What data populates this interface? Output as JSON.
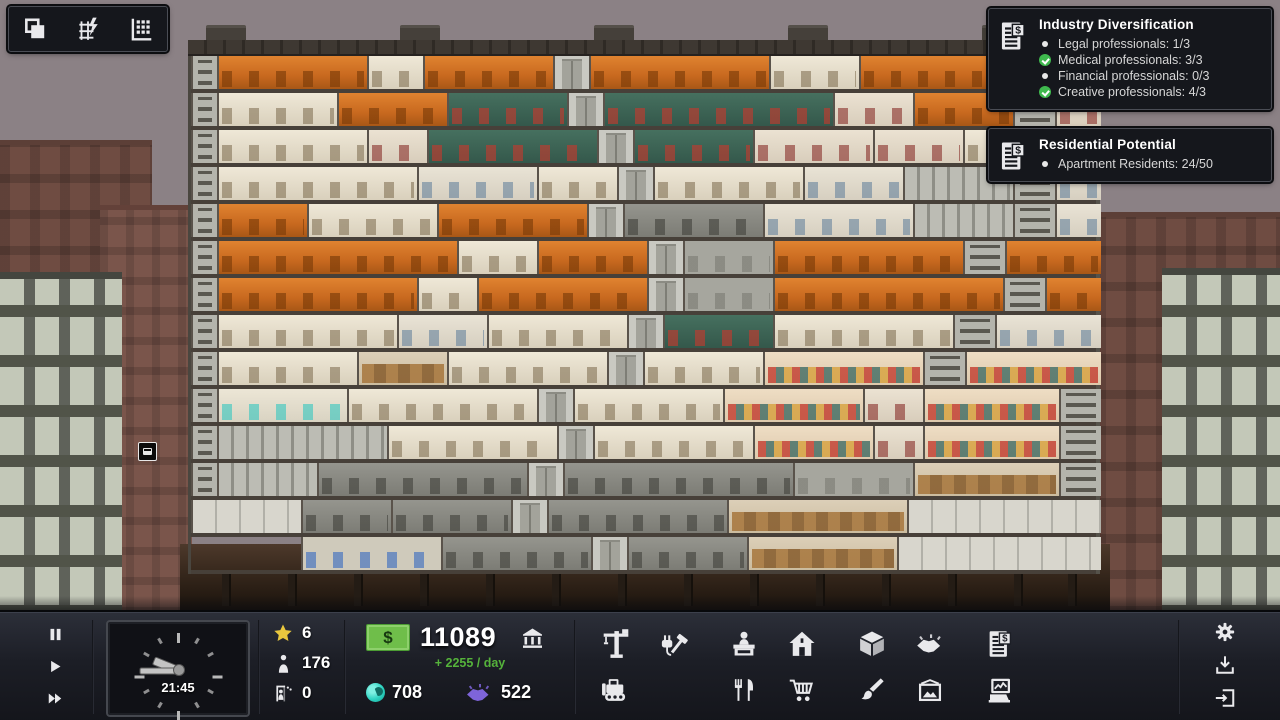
{
  "palette": {
    "sky": "#8b8185",
    "toolbar_bg": "#1c1e26",
    "panel_bg": "#15171c",
    "money_green": "#6fbe4a",
    "income_green": "#55b33b",
    "star_yellow": "#e9c73e",
    "influence_cyan": "#2fd3c2",
    "favors_purple": "#7e64da",
    "check_green": "#3fb94e",
    "office_orange": "#c8691f",
    "diner_teal": "#3f685e"
  },
  "top_left_toolbar": {
    "buttons": [
      {
        "icon": "layers-icon"
      },
      {
        "icon": "power-grid-icon"
      },
      {
        "icon": "building-stats-icon"
      }
    ]
  },
  "notifications": [
    {
      "icon": "financial-report-icon",
      "title": "Industry Diversification",
      "items": [
        {
          "text": "Legal professionals: 1/3",
          "state": "open"
        },
        {
          "text": "Medical professionals: 3/3",
          "state": "done"
        },
        {
          "text": "Financial professionals: 0/3",
          "state": "open"
        },
        {
          "text": "Creative professionals: 4/3",
          "state": "done"
        }
      ]
    },
    {
      "icon": "financial-report-icon",
      "title": "Residential Potential",
      "items": [
        {
          "text": "Apartment Residents: 24/50",
          "state": "open"
        }
      ]
    }
  ],
  "toolbar": {
    "clock": {
      "time": "21:45"
    },
    "stats": {
      "prestige": "6",
      "population": "176",
      "vacancies": "0"
    },
    "finance": {
      "currency_symbol": "$",
      "balance": "11089",
      "income_per_day": "+ 2255 / day",
      "influence": "708",
      "favors": "522"
    },
    "tool_icons": [
      "crane",
      "utilities-repair",
      "bulldozer",
      "receptionist",
      "house",
      "food-service",
      "retail-cart",
      "services-box",
      "deals-handshake",
      "contracts-report",
      "decorate-brush",
      "artwork-picture",
      "reports-computer"
    ],
    "system_icons": [
      "settings-gear",
      "save-download",
      "exit-door"
    ]
  },
  "building": {
    "floors": [
      [
        [
          26,
          "shaft"
        ],
        [
          150,
          "office"
        ],
        [
          56,
          "studio"
        ],
        [
          130,
          "office"
        ],
        [
          36,
          "elevator"
        ],
        [
          180,
          "office"
        ],
        [
          90,
          "studio"
        ],
        [
          150,
          "office"
        ],
        [
          46,
          "shaft"
        ],
        [
          46,
          "office"
        ]
      ],
      [
        [
          26,
          "shaft"
        ],
        [
          120,
          "studio"
        ],
        [
          110,
          "office"
        ],
        [
          120,
          "diner"
        ],
        [
          36,
          "elevator"
        ],
        [
          230,
          "diner"
        ],
        [
          80,
          "medical"
        ],
        [
          100,
          "office"
        ],
        [
          42,
          "shaft"
        ],
        [
          46,
          "medical"
        ]
      ],
      [
        [
          26,
          "shaft"
        ],
        [
          150,
          "studio"
        ],
        [
          60,
          "medical"
        ],
        [
          170,
          "diner"
        ],
        [
          36,
          "elevator"
        ],
        [
          120,
          "diner"
        ],
        [
          120,
          "medical"
        ],
        [
          90,
          "medical"
        ],
        [
          96,
          "studio"
        ],
        [
          42,
          "shaft"
        ]
      ],
      [
        [
          26,
          "shaft"
        ],
        [
          200,
          "studio"
        ],
        [
          120,
          "apartment"
        ],
        [
          80,
          "studio"
        ],
        [
          36,
          "elevator"
        ],
        [
          150,
          "studio"
        ],
        [
          100,
          "apartment"
        ],
        [
          110,
          "lockers"
        ],
        [
          42,
          "shaft"
        ],
        [
          46,
          "apartment"
        ]
      ],
      [
        [
          26,
          "shaft"
        ],
        [
          90,
          "office"
        ],
        [
          130,
          "studio"
        ],
        [
          150,
          "office"
        ],
        [
          36,
          "elevator"
        ],
        [
          140,
          "utility"
        ],
        [
          150,
          "apartment"
        ],
        [
          100,
          "lockers"
        ],
        [
          42,
          "shaft"
        ],
        [
          46,
          "apartment"
        ]
      ],
      [
        [
          26,
          "shaft"
        ],
        [
          240,
          "office"
        ],
        [
          80,
          "studio"
        ],
        [
          110,
          "office"
        ],
        [
          36,
          "elevator"
        ],
        [
          90,
          "gray"
        ],
        [
          190,
          "office"
        ],
        [
          42,
          "shaft"
        ],
        [
          96,
          "office"
        ]
      ],
      [
        [
          26,
          "shaft"
        ],
        [
          200,
          "office"
        ],
        [
          60,
          "studio"
        ],
        [
          170,
          "office"
        ],
        [
          36,
          "elevator"
        ],
        [
          90,
          "gray"
        ],
        [
          230,
          "office"
        ],
        [
          42,
          "shaft"
        ],
        [
          56,
          "office"
        ]
      ],
      [
        [
          26,
          "shaft"
        ],
        [
          180,
          "studio"
        ],
        [
          90,
          "apartment"
        ],
        [
          140,
          "studio"
        ],
        [
          36,
          "elevator"
        ],
        [
          110,
          "diner"
        ],
        [
          180,
          "studio"
        ],
        [
          42,
          "shaft"
        ],
        [
          106,
          "apartment"
        ]
      ],
      [
        [
          26,
          "shaft"
        ],
        [
          140,
          "studio"
        ],
        [
          90,
          "storage"
        ],
        [
          160,
          "studio"
        ],
        [
          36,
          "elevator"
        ],
        [
          120,
          "studio"
        ],
        [
          160,
          "market"
        ],
        [
          42,
          "shaft"
        ],
        [
          136,
          "market"
        ]
      ],
      [
        [
          26,
          "shaft"
        ],
        [
          130,
          "laundry"
        ],
        [
          190,
          "studio"
        ],
        [
          36,
          "elevator"
        ],
        [
          150,
          "studio"
        ],
        [
          140,
          "market"
        ],
        [
          60,
          "medical"
        ],
        [
          136,
          "market"
        ],
        [
          42,
          "shaft"
        ]
      ],
      [
        [
          26,
          "shaft"
        ],
        [
          170,
          "lockers"
        ],
        [
          170,
          "studio"
        ],
        [
          36,
          "elevator"
        ],
        [
          160,
          "studio"
        ],
        [
          120,
          "market"
        ],
        [
          50,
          "medical"
        ],
        [
          136,
          "market"
        ],
        [
          42,
          "shaft"
        ]
      ],
      [
        [
          26,
          "shaft"
        ],
        [
          100,
          "lockers"
        ],
        [
          210,
          "utility"
        ],
        [
          36,
          "elevator"
        ],
        [
          230,
          "utility"
        ],
        [
          120,
          "gray"
        ],
        [
          146,
          "storage"
        ],
        [
          42,
          "shaft"
        ]
      ],
      [
        [
          110,
          "plate"
        ],
        [
          90,
          "utility"
        ],
        [
          120,
          "utility"
        ],
        [
          36,
          "elevator"
        ],
        [
          180,
          "utility"
        ],
        [
          180,
          "storage"
        ],
        [
          194,
          "plate"
        ]
      ],
      [
        [
          110,
          "void"
        ],
        [
          140,
          "basement"
        ],
        [
          150,
          "utility"
        ],
        [
          36,
          "elevator"
        ],
        [
          120,
          "utility"
        ],
        [
          150,
          "storage"
        ],
        [
          204,
          "plate"
        ]
      ]
    ],
    "vents_x": [
      18,
      212,
      406,
      600,
      794
    ],
    "piles_x": [
      42,
      108,
      174,
      240,
      306,
      372,
      438,
      504,
      570,
      636,
      702,
      768,
      834,
      888
    ]
  }
}
